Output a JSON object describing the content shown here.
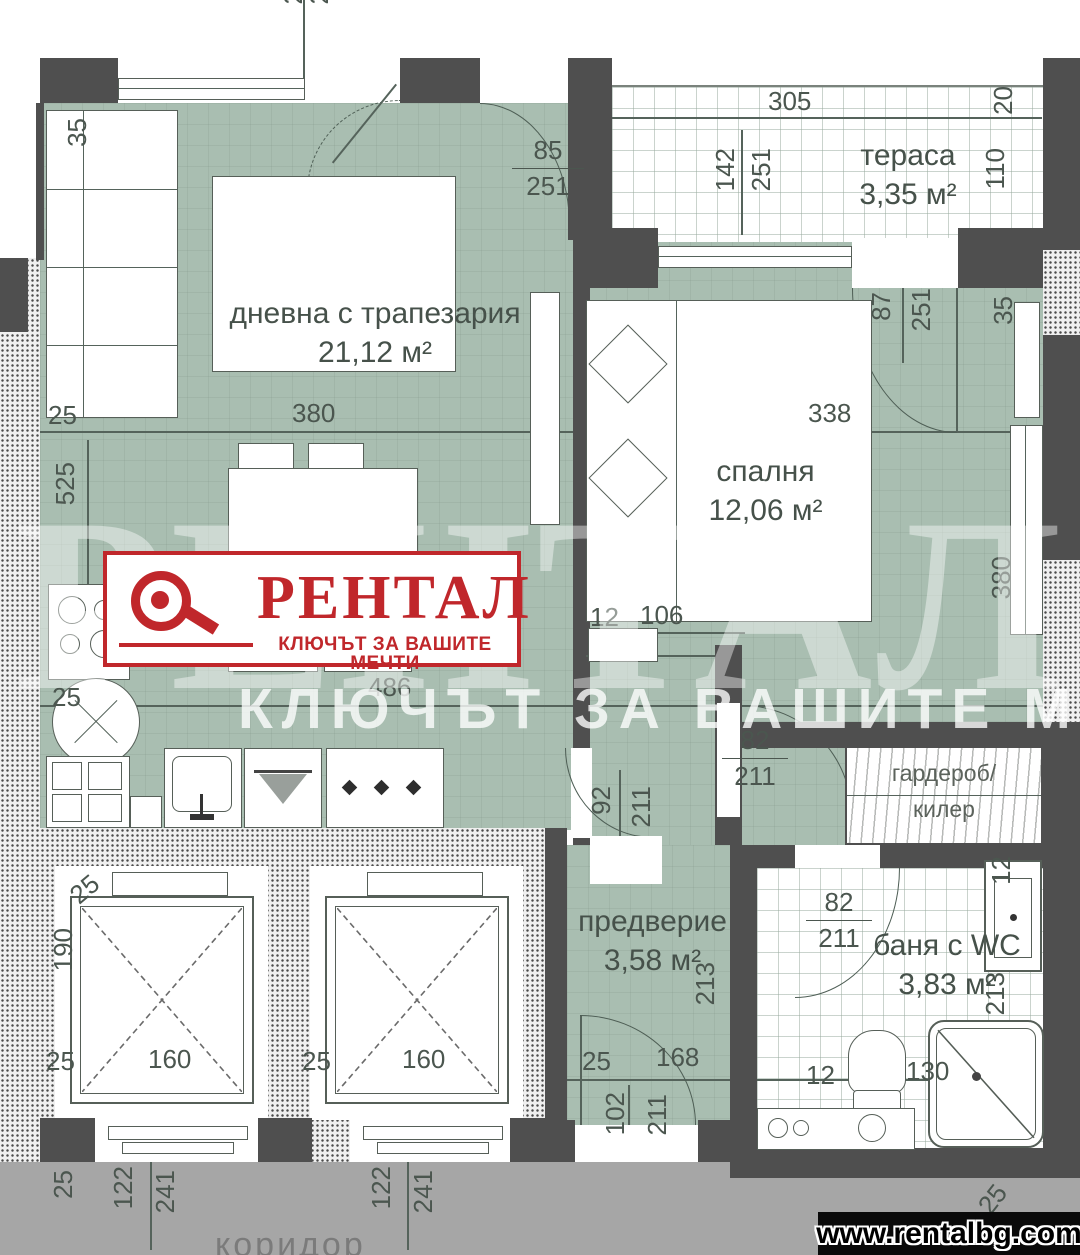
{
  "colors": {
    "accent_red": "#c0272b",
    "floor_green": "#a9beb1",
    "wall_gray": "#4f4f4f",
    "corridor_gray": "#a6a6a6"
  },
  "branding": {
    "logo_text": "РЕНТАЛ",
    "logo_tagline": "КЛЮЧЪТ ЗА ВАШИТЕ МЕЧТИ",
    "watermark_text": "РЕНТАЛ",
    "watermark_tagline": "КЛЮЧЪТ ЗА ВАШИТЕ МЕЧТИ",
    "website": "www.rentalbg.com"
  },
  "rooms": {
    "living": {
      "name": "дневна с трапезария",
      "area": "21,12 м²"
    },
    "terrace": {
      "name": "тераса",
      "area": "3,35 м²"
    },
    "bedroom": {
      "name": "спалня",
      "area": "12,06 м²"
    },
    "entry": {
      "name": "предверие",
      "area": "3,58 м²"
    },
    "bath": {
      "name": "баня с WC",
      "area": "3,83 м²"
    },
    "wardrobe": {
      "line1": "гардероб/",
      "line2": "килер"
    },
    "corridor": {
      "name": "коридор"
    }
  },
  "dims": {
    "terrace_w": "305",
    "terrace_end": "20",
    "terrace_v1": "142",
    "terrace_v2": "251",
    "terrace_d": "110",
    "balcony_w": "85",
    "balcony_h": "251",
    "wall_tl": "35",
    "wall_tr": "35",
    "living_w": "380",
    "living_h": "525",
    "kitchen_w": "486",
    "off_tl": "25",
    "off_ml": "25",
    "bedroom_w": "338",
    "bedroom_h": "380",
    "tdoor_w": "87",
    "tdoor_h": "251",
    "bed_a": "12",
    "bed_b": "106",
    "bdoor_w": "82",
    "bdoor_h": "211",
    "ldoor_w": "92",
    "ldoor_h": "211",
    "wdoor_w": "82",
    "wdoor_h": "211",
    "entry_h": "213",
    "bath_h": "213",
    "wm_w": "12",
    "bath_a": "12",
    "bath_b": "130",
    "corner_br": "25",
    "corner_bl": "25",
    "elev_top": "25",
    "elev_h": "190",
    "elev1_off": "25",
    "elev1_w": "160",
    "elev2_off": "25",
    "elev2_w": "160",
    "door1_a": "122",
    "door1_b": "241",
    "door2_a": "122",
    "door2_b": "241",
    "entry_off": "25",
    "entry_w": "168",
    "edoor_w": "102",
    "edoor_h": "211",
    "cut_a": "2",
    "cut_b": "2"
  }
}
